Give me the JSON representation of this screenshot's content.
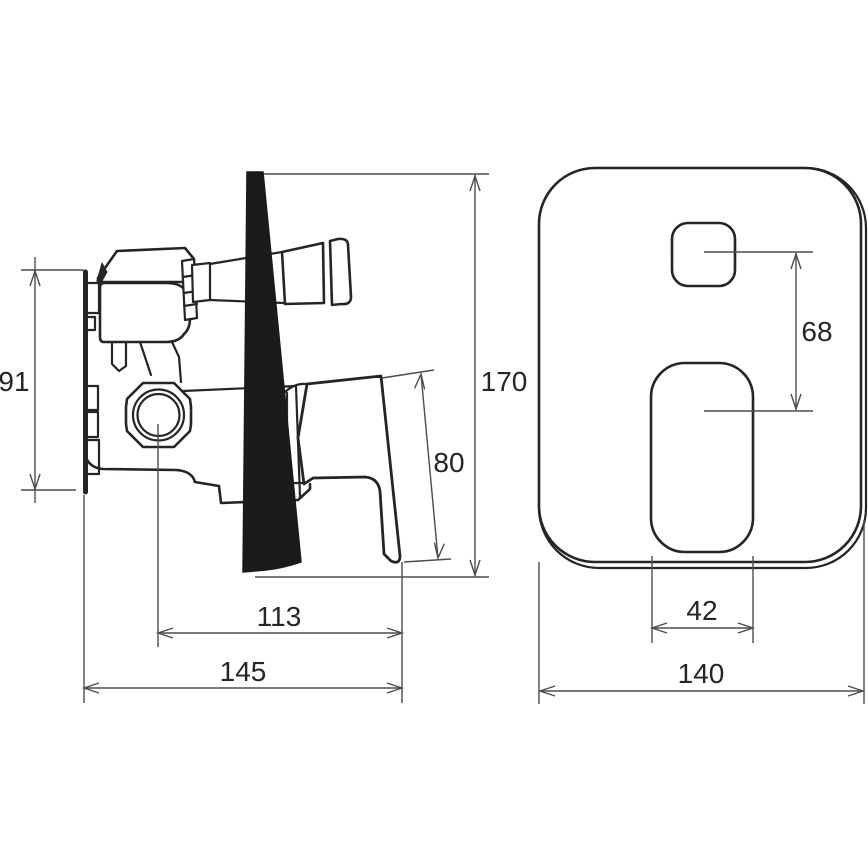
{
  "colors": {
    "line": "#272425",
    "dim": "#4d4d4d",
    "blade": "#1b1b1b",
    "background": "#ffffff"
  },
  "side_view": {
    "dimensions": {
      "body_height": "91",
      "overall_height": "170",
      "handle_length": "80",
      "valve_axis_depth": "113",
      "overall_depth": "145"
    }
  },
  "front_view": {
    "dimensions": {
      "button_to_lever_spacing": "68",
      "lever_cutout_width": "42",
      "plate_width": "140"
    }
  }
}
